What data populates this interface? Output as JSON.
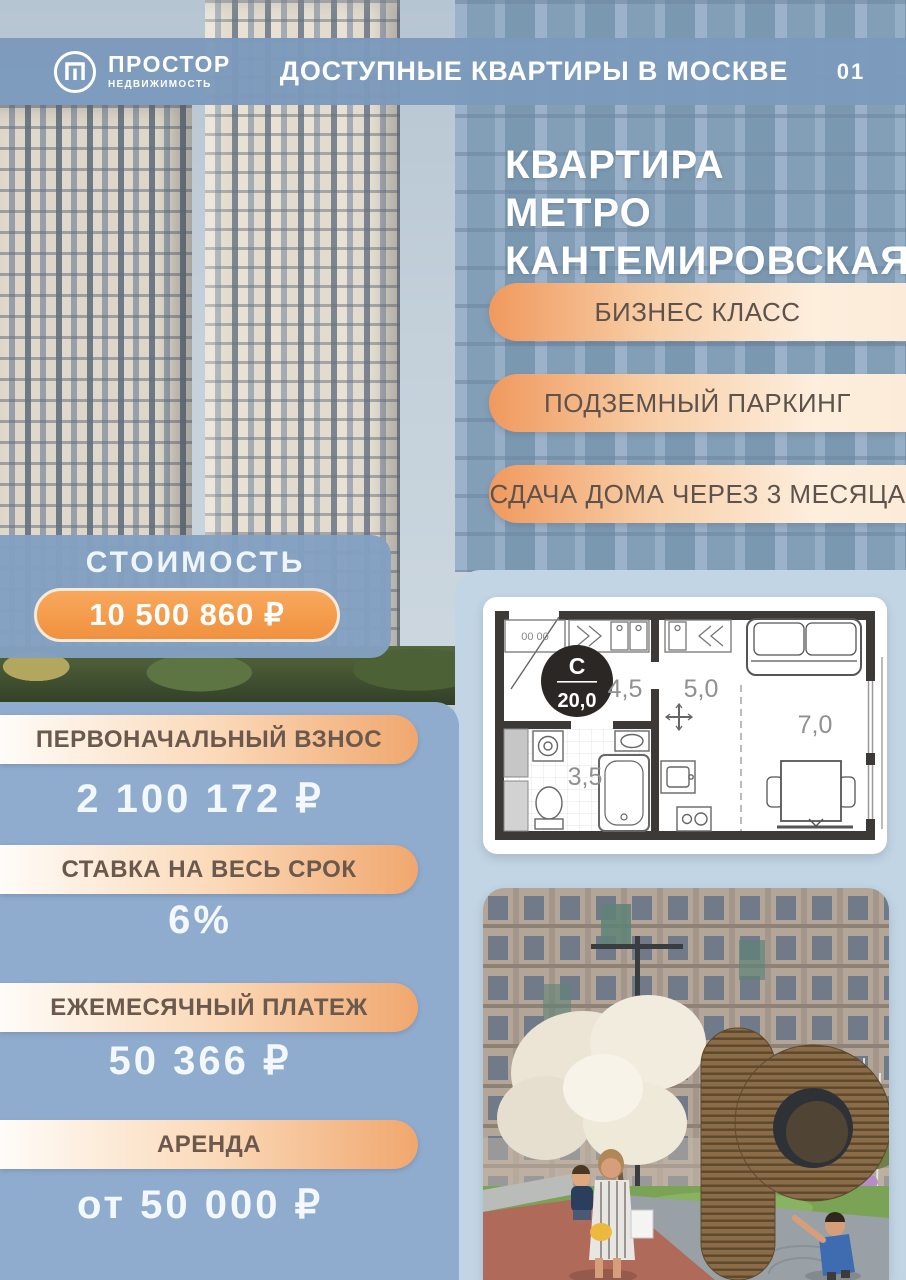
{
  "header": {
    "logo_title": "ПРОСТОР",
    "logo_subtitle": "НЕДВИЖИМОСТЬ",
    "title": "ДОСТУПНЫЕ КВАРТИРЫ В МОСКВЕ",
    "page_number": "01"
  },
  "hero": {
    "heading_line1": "КВАРТИРА",
    "heading_line2": "МЕТРО",
    "heading_line3": "КАНТЕМИРОВСКАЯ",
    "features": [
      "БИЗНЕС КЛАСС",
      "ПОДЗЕМНЫЙ ПАРКИНГ",
      "СДАЧА ДОМА ЧЕРЕЗ 3 МЕСЯЦА"
    ]
  },
  "price": {
    "label": "СТОИМОСТЬ",
    "value": "10 500 860 ₽"
  },
  "mortgage": {
    "items": [
      {
        "label": "ПЕРВОНАЧАЛЬНЫЙ ВЗНОС",
        "value": "2 100 172 ₽"
      },
      {
        "label": "СТАВКА НА ВЕСЬ СРОК",
        "value": "6%"
      },
      {
        "label": "ЕЖЕМЕСЯЧНЫЙ ПЛАТЕЖ",
        "value": "50 366 ₽"
      },
      {
        "label": "АРЕНДА",
        "value": "от 50 000 ₽"
      }
    ]
  },
  "floorplan": {
    "type_label": "С",
    "total_area": "20,0",
    "closet_marking": "00 00",
    "areas": {
      "hallway": "4,5",
      "kitchen": "5,0",
      "living": "7,0",
      "bathroom": "3,5"
    }
  },
  "colors": {
    "header_blue": "#7c9abc",
    "panel_blue": "#8fabce",
    "panel_light_blue": "#c2d5e5",
    "accent_orange": "#f0913f",
    "pill_gradient_start": "#f0995e",
    "pill_gradient_end": "#fdecd9",
    "text_dark": "#5d534c",
    "text_white": "#ffffff"
  }
}
